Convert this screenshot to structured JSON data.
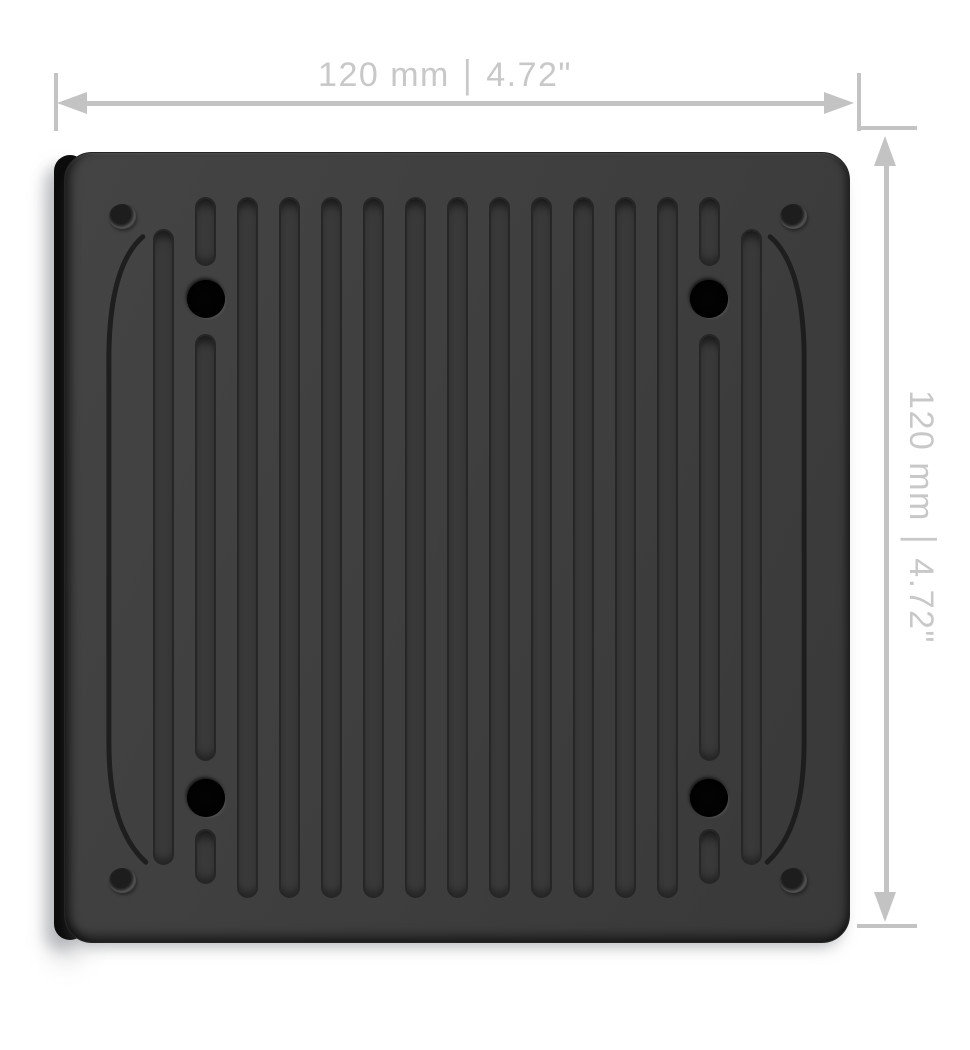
{
  "width_dimension": {
    "mm_value": "120 mm",
    "separator": "|",
    "inch_value": "4.72\""
  },
  "height_dimension": {
    "mm_value": "120 mm",
    "separator": "|",
    "inch_value": "4.72\""
  },
  "colors": {
    "background": "#ffffff",
    "dimension_line": "#c3c3c4",
    "dimension_text": "#c8c8c9",
    "panel_face": "#3f3f3f",
    "panel_side": "#0c0c0c",
    "groove": "#393939",
    "groove_edge": "#262626",
    "arc_engraving": "#1b1b1b",
    "screw_hole": "#030303"
  }
}
